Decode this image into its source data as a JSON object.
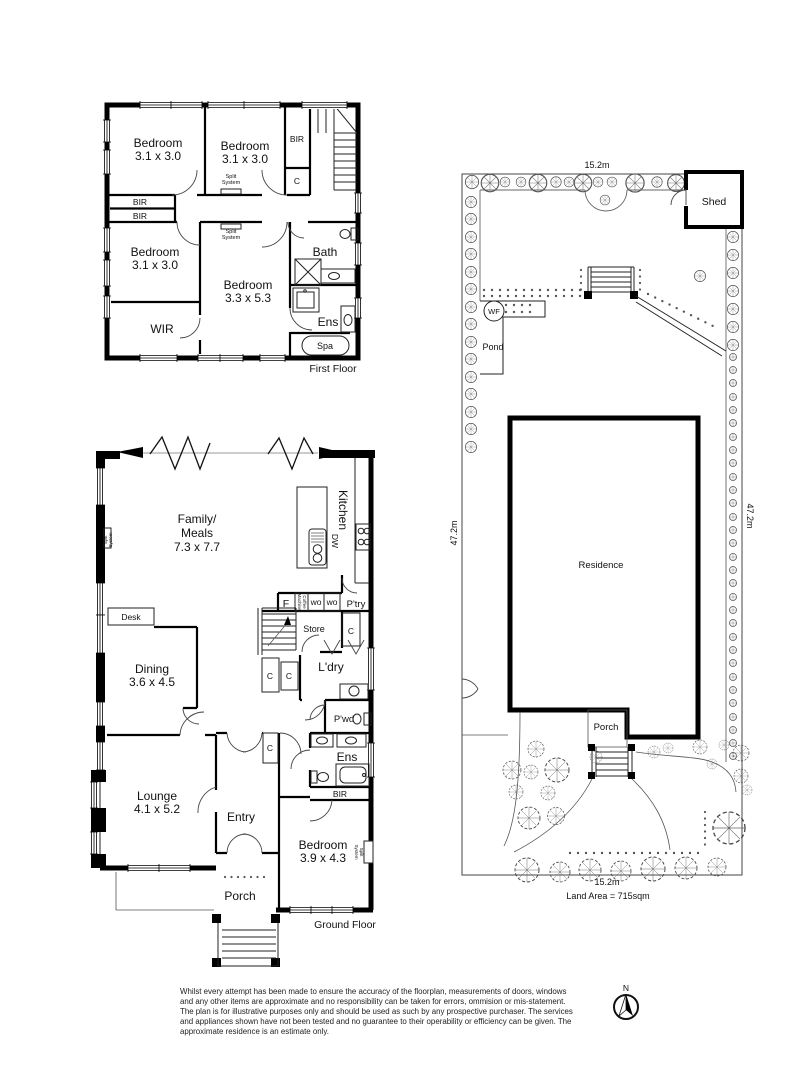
{
  "first_floor": {
    "floor_label": "First Floor",
    "bedroom_tl_name": "Bedroom",
    "bedroom_tl_dim": "3.1 x 3.0",
    "bedroom_tm_name": "Bedroom",
    "bedroom_tm_dim": "3.1 x 3.0",
    "bedroom_bl_name": "Bedroom",
    "bedroom_bl_dim": "3.1 x 3.0",
    "bedroom_main_name": "Bedroom",
    "bedroom_main_dim": "3.3 x 5.3",
    "bir_top": "BIR",
    "closet_top": "C",
    "bir_left_1": "BIR",
    "bir_left_2": "BIR",
    "split_system_line1": "Split",
    "split_system_line2": "System",
    "bath": "Bath",
    "ens": "Ens",
    "spa": "Spa",
    "wir": "WIR"
  },
  "ground_floor": {
    "floor_label": "Ground Floor",
    "family_line1": "Family/",
    "family_line2": "Meals",
    "family_dim": "7.3 x 7.7",
    "kitchen": "Kitchen",
    "dw": "DW",
    "desk": "Desk",
    "dining_name": "Dining",
    "dining_dim": "3.6 x 4.5",
    "lounge_name": "Lounge",
    "lounge_dim": "4.1 x 5.2",
    "entry": "Entry",
    "porch": "Porch",
    "bedroom_name": "Bedroom",
    "bedroom_dim": "3.9 x 4.3",
    "fridge": "F",
    "coffee_line1": "Coffee",
    "coffee_line2": "Machine",
    "wall_oven_1": "wo",
    "wall_oven_2": "wo",
    "pantry": "P'try",
    "store": "Store",
    "laundry": "L'dry",
    "closet_1": "C",
    "closet_2": "C",
    "closet_hall": "C",
    "closet_entry": "C",
    "powder": "P'wd",
    "ens": "Ens",
    "bir": "BIR",
    "split_system_line1": "Split",
    "split_system_line2": "System"
  },
  "site_plan": {
    "width_top": "15.2m",
    "width_bottom": "15.2m",
    "depth_left": "47.2m",
    "depth_right": "47.2m",
    "shed": "Shed",
    "water_feature": "WF",
    "pond": "Pond",
    "residence": "Residence",
    "porch": "Porch",
    "land_area": "Land Area = 715sqm"
  },
  "footer": {
    "disclaimer": "Whilst every attempt has been made to ensure the accuracy of the floorplan, measurements of doors, windows and any other items are approximate and no responsibility can be taken for errors, ommision or mis-statement. The plan is for illustrative purposes only and should be used as such by any prospective purchaser. The services and appliances shown have not been tested and no guarantee to their operability or efficiency can be given. The approximate residence is an estimate only.",
    "compass_north": "N"
  }
}
